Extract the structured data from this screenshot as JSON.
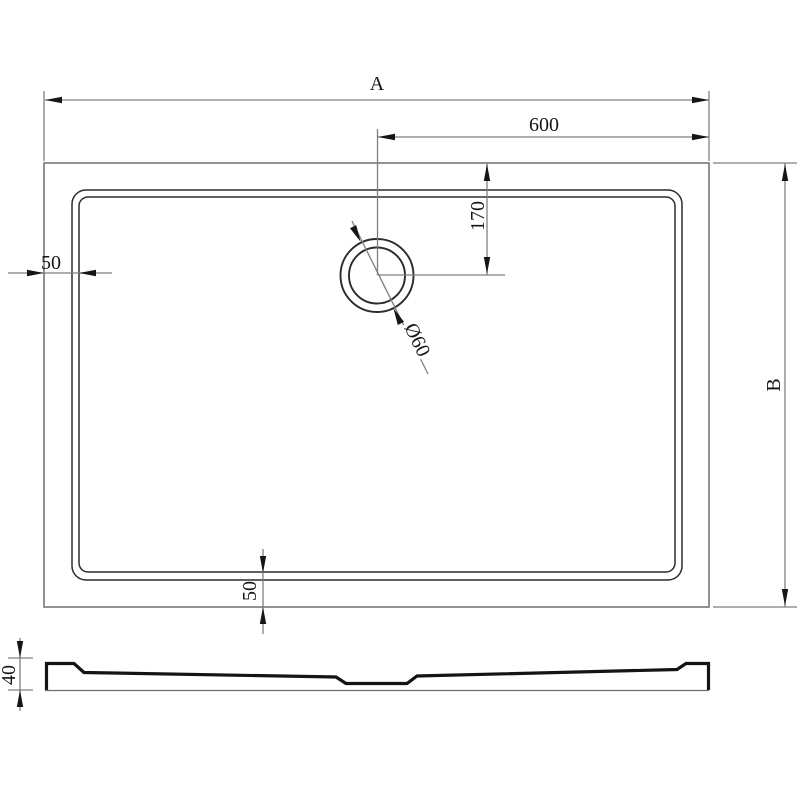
{
  "drawing": {
    "kind": "technical-drawing-shower-tray",
    "views": [
      "top-view",
      "side-profile-view"
    ]
  },
  "dims": {
    "overall_width": "A",
    "drain_offset_x": "600",
    "drain_offset_y": "170",
    "drain_diameter": "Ø60",
    "rim_left": "50",
    "rim_bottom": "50",
    "overall_height": "B",
    "profile_height": "40"
  },
  "colors": {
    "background": "#ffffff",
    "dimension_lines": "#7f7f7f",
    "tray_lines": "#2b2b2b",
    "ink": "#161616",
    "profile": "#141414"
  }
}
